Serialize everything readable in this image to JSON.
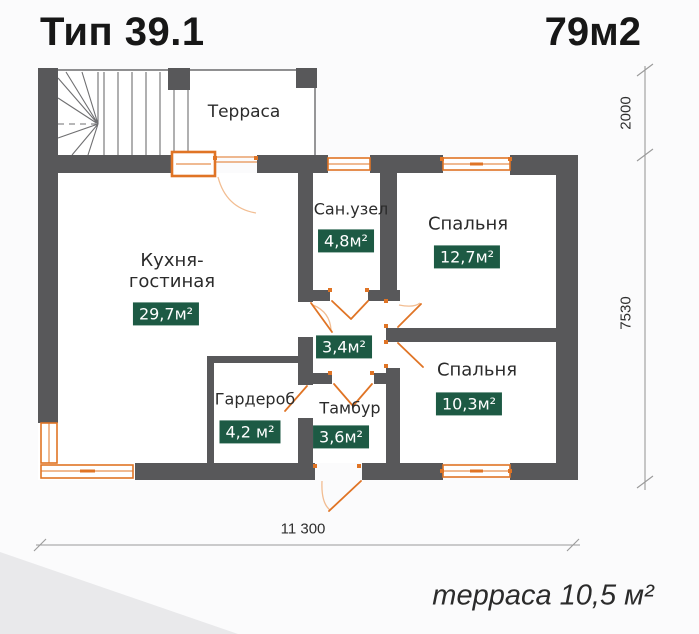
{
  "title": "Тип 39.1",
  "total_area": "79м2",
  "plan": {
    "rooms": {
      "terrace": {
        "name": "Терраса"
      },
      "kitchen": {
        "name": "Кухня-\nгостиная",
        "area": "29,7м²"
      },
      "bathroom": {
        "name": "Сан.узел",
        "area": "4,8м²"
      },
      "bedroom1": {
        "name": "Спальня",
        "area": "12,7м²"
      },
      "hall": {
        "area": "3,4м²"
      },
      "wardrobe": {
        "name": "Гардероб",
        "area": "4,2 м²"
      },
      "vestibule": {
        "name": "Тамбур",
        "area": "3,6м²"
      },
      "bedroom2": {
        "name": "Спальня",
        "area": "10,3м²"
      }
    },
    "dimensions": {
      "right_top": "2000",
      "right_main": "7530",
      "bottom": "11 300"
    }
  },
  "footer": {
    "terrace_area_note": "терраса 10,5 м²"
  },
  "colors": {
    "wall": "#58585a",
    "accent": "#e07425",
    "accent-light": "#f2bd92",
    "badge": "#1d5a44",
    "dim": "#9a9a9a",
    "text": "#2b2b2b"
  }
}
